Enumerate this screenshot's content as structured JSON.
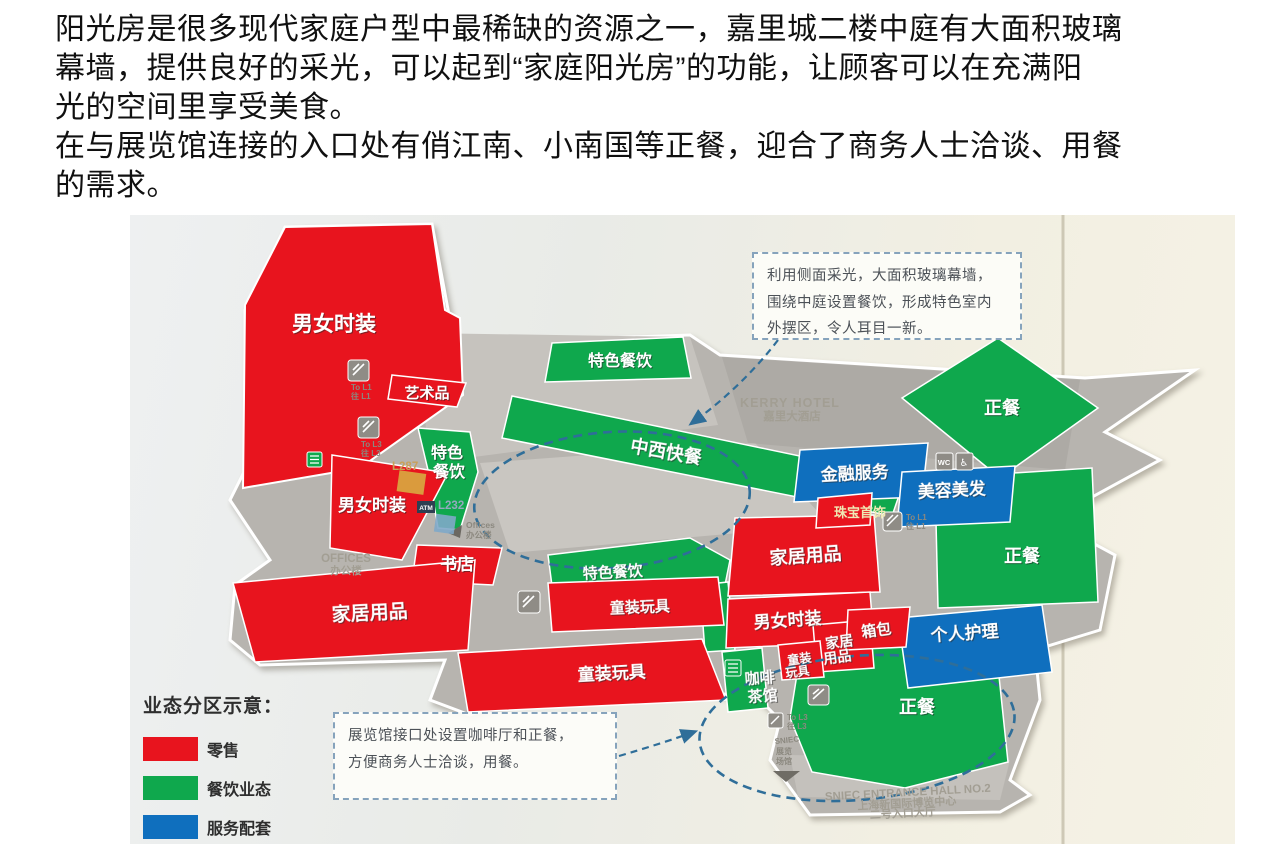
{
  "page": {
    "background": "#ffffff"
  },
  "intro": {
    "lines": [
      "阳光房是很多现代家庭户型中最稀缺的资源之一，嘉里城二楼中庭有大面积玻璃",
      "幕墙，提供良好的采光，可以起到“家庭阳光房”的功能，让顾客可以在充满阳",
      "光的空间里享受美食。",
      "在与展览馆连接的入口处有俏江南、小南国等正餐，迎合了商务人士洽谈、用餐",
      "的需求。"
    ]
  },
  "map": {
    "colors": {
      "retail": "#e8141e",
      "dining": "#0fa84d",
      "service": "#0f6fbe",
      "floor": "#b7b4af",
      "dashed_line": "#2f6e99"
    },
    "zones": [
      {
        "id": "fashion-top",
        "label": "男女时装",
        "category": "retail"
      },
      {
        "id": "art-goods",
        "label": "艺术品",
        "category": "retail"
      },
      {
        "id": "fashion-left",
        "label": "男女时装",
        "category": "retail"
      },
      {
        "id": "bookstore",
        "label": "书店",
        "category": "retail"
      },
      {
        "id": "home-goods-left",
        "label": "家居用品",
        "category": "retail"
      },
      {
        "id": "kids-toys-upper",
        "label": "童装玩具",
        "category": "retail"
      },
      {
        "id": "kids-toys-lower",
        "label": "童装玩具",
        "category": "retail"
      },
      {
        "id": "fashion-center",
        "label": "男女时装",
        "category": "retail"
      },
      {
        "id": "home-goods-center",
        "label": "家居用品",
        "category": "retail"
      },
      {
        "id": "luggage",
        "label": "箱包",
        "category": "retail"
      },
      {
        "id": "home-goods-small",
        "label": "家居",
        "label2": "用品",
        "category": "retail"
      },
      {
        "id": "kids-toys-small",
        "label": "童装",
        "label2": "玩具",
        "category": "retail"
      },
      {
        "id": "jewelry",
        "label": "珠宝首饰",
        "category": "retail"
      },
      {
        "id": "special-dining-top",
        "label": "特色餐饮",
        "category": "dining"
      },
      {
        "id": "fast-food",
        "label": "中西快餐",
        "category": "dining"
      },
      {
        "id": "special-dining-left",
        "label": "特色",
        "label2": "餐饮",
        "category": "dining"
      },
      {
        "id": "special-dining-center",
        "label": "特色餐饮",
        "category": "dining"
      },
      {
        "id": "coffee-teahouse",
        "label": "咖啡",
        "label2": "茶馆",
        "category": "dining"
      },
      {
        "id": "dinner-northeast",
        "label": "正餐",
        "category": "dining"
      },
      {
        "id": "dinner-east",
        "label": "正餐",
        "category": "dining"
      },
      {
        "id": "dinner-south",
        "label": "正餐",
        "category": "dining"
      },
      {
        "id": "financial-services",
        "label": "金融服务",
        "category": "service"
      },
      {
        "id": "beauty-hair",
        "label": "美容美发",
        "category": "service"
      },
      {
        "id": "personal-care",
        "label": "个人护理",
        "category": "service"
      }
    ],
    "hotel": {
      "en": "KERRY HOTEL",
      "cn": "嘉里大酒店"
    },
    "offices": {
      "en": "OFFICES",
      "cn": "办公楼"
    },
    "offices_small": {
      "en": "Offices",
      "cn": "办公楼"
    },
    "sniec_hall": {
      "l1": "SNIEC",
      "l2": "展览",
      "l3": "场馆"
    },
    "sniec_entrance": {
      "en": "SNIEC ENTRANCE HALL NO.2",
      "cn1": "上海新国际博览中心",
      "cn2": "二号入口大厅"
    },
    "wayfinding": {
      "to_l1": "To L1",
      "to_l1_cn": "往 L1",
      "to_l3": "To L3",
      "to_l3_cn": "往 L3",
      "unit_l287": "L287",
      "unit_l232": "L232",
      "atm": "ATM",
      "wc": "WC"
    },
    "callouts": {
      "atrium": {
        "lines": [
          "利用侧面采光，大面积玻璃幕墙，",
          "围绕中庭设置餐饮，形成特色室内",
          "外摆区，令人耳目一新。"
        ]
      },
      "entrance": {
        "lines": [
          "展览馆接口处设置咖啡厅和正餐，",
          "方便商务人士洽谈，用餐。"
        ]
      }
    },
    "legend": {
      "title": "业态分区示意：",
      "items": [
        {
          "label": "零售",
          "color": "#e8141e"
        },
        {
          "label": "餐饮业态",
          "color": "#0fa84d"
        },
        {
          "label": "服务配套",
          "color": "#0f6fbe"
        }
      ]
    }
  }
}
